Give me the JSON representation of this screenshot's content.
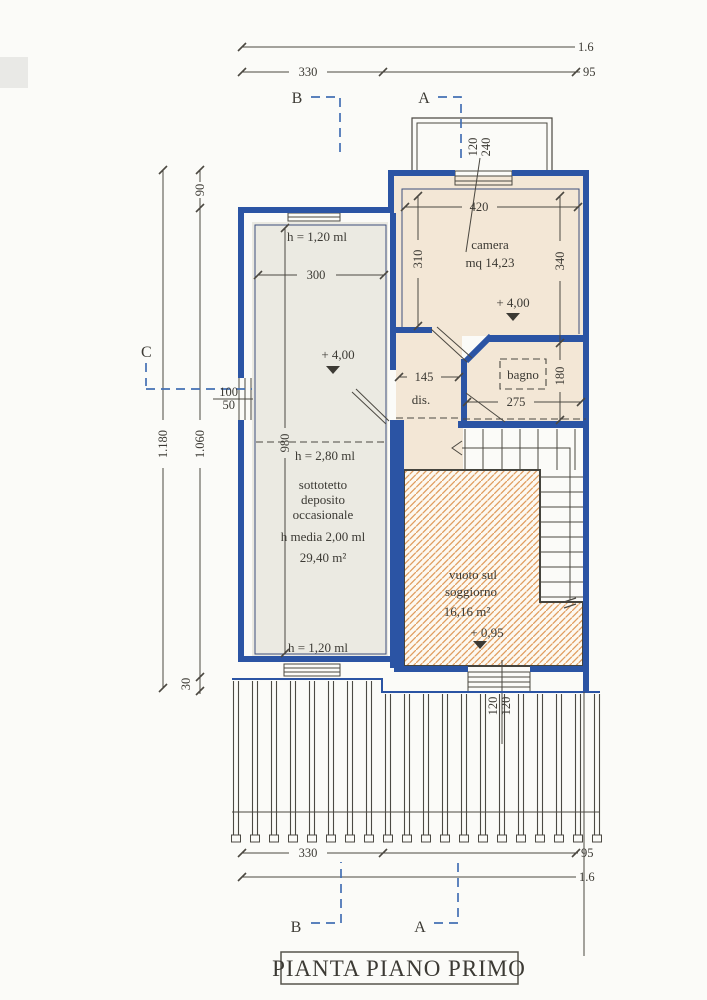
{
  "title": "PIANTA PIANO PRIMO",
  "sections": {
    "a": "A",
    "b": "B",
    "c": "C"
  },
  "colors": {
    "wall_blue": "#2b54a4",
    "section_blue": "#4470b4",
    "line_dark": "#4b4841",
    "room_beige": "#f3e7d6",
    "room_gray": "#ebeae2",
    "hatch_orange": "#e09d5f",
    "paper": "#fbfbf8"
  },
  "dims": {
    "top_total": "1.6",
    "top_330": "330",
    "top_95": "95",
    "bottom_330": "330",
    "bottom_95": "95",
    "bottom_total": "1.6",
    "left_90": "90",
    "left_1180": "1.180",
    "left_1060": "1.060",
    "left_30": "30",
    "win_left_100": "100",
    "win_left_50": "50",
    "win_top_120": "120",
    "win_top_240": "240",
    "win_bottom_120a": "120",
    "win_bottom_120b": "120",
    "camera_420": "420",
    "camera_310": "310",
    "camera_340": "340",
    "sotto_300": "300",
    "sotto_980": "980",
    "dis_145": "145",
    "bagno_275": "275",
    "bagno_180": "180"
  },
  "rooms": {
    "camera": {
      "name": "camera",
      "area": "mq 14,23",
      "level": "+ 4,00"
    },
    "bagno": {
      "name": "bagno"
    },
    "dis": {
      "name": "dis."
    },
    "sottotetto": {
      "h_top": "h = 1,20 ml",
      "h_mid": "h = 2,80 ml",
      "h_bottom": "h = 1,20 ml",
      "name1": "sottotetto",
      "name2": "deposito",
      "name3": "occasionale",
      "h_media": "h media 2,00 ml",
      "area": "29,40 m²",
      "level": "+ 4,00"
    },
    "vuoto": {
      "name1": "vuoto sul",
      "name2": "soggiorno",
      "area": "16,16 m²",
      "level": "+ 0,95"
    }
  }
}
